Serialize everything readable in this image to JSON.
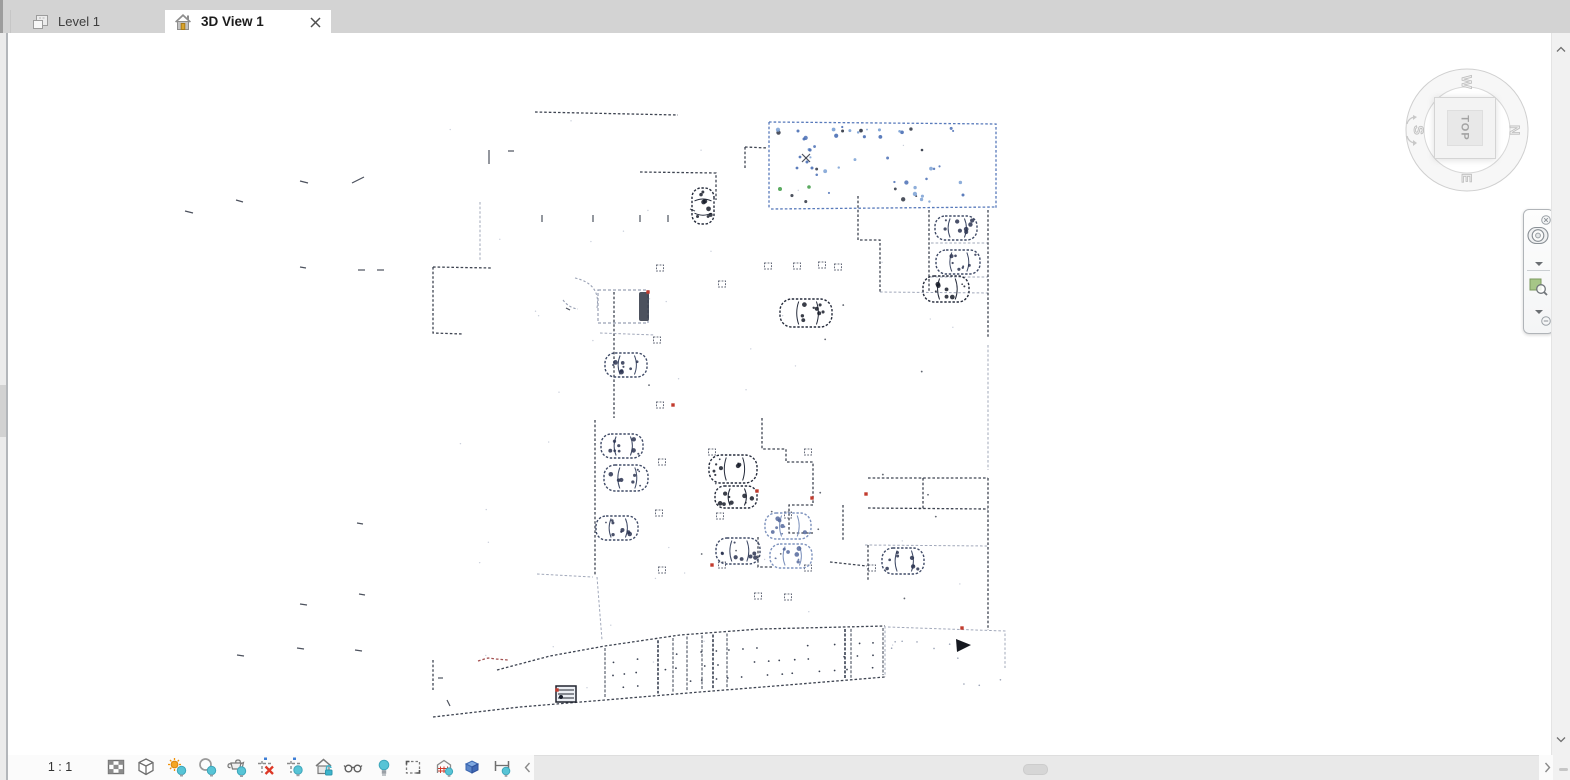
{
  "tabs": [
    {
      "id": "level-1",
      "label": "Level 1",
      "active": false,
      "icon": "floor-plan-icon"
    },
    {
      "id": "3d-view-1",
      "label": "3D View 1",
      "active": true,
      "icon": "home-icon",
      "closable": true
    }
  ],
  "viewcube": {
    "face_label": "TOP",
    "compass": {
      "north": "N",
      "south": "S",
      "east": "E",
      "west": "W"
    },
    "rotation_deg": 90
  },
  "navigation_bar": {
    "close_icon": "close-icon",
    "minimize_icon": "minimize-icon",
    "buttons": [
      {
        "icon": "steering-wheel-icon"
      },
      {
        "icon": "wheel-menu-caret-icon"
      },
      {
        "icon": "zoom-region-icon"
      },
      {
        "icon": "zoom-menu-caret-icon"
      }
    ]
  },
  "view_control_bar": {
    "scale_label": "1 : 1",
    "buttons": [
      {
        "icon": "detail-level-icon"
      },
      {
        "icon": "visual-style-icon"
      },
      {
        "icon": "sun-path-icon"
      },
      {
        "icon": "shadows-icon"
      },
      {
        "icon": "show-rendering-dialog-icon"
      },
      {
        "icon": "crop-view-icon"
      },
      {
        "icon": "show-crop-region-icon"
      },
      {
        "icon": "unlocked-3d-view-icon"
      },
      {
        "icon": "temporary-hide-isolate-icon"
      },
      {
        "icon": "reveal-hidden-elements-icon"
      },
      {
        "icon": "temporary-view-properties-icon"
      },
      {
        "icon": "analytical-model-icon"
      },
      {
        "icon": "displacement-sets-icon"
      },
      {
        "icon": "reveal-constraints-icon"
      }
    ]
  },
  "scrollbars": {
    "horizontal": {
      "thumb_left": 1023,
      "thumb_width": 23
    },
    "left_gutter": {
      "thumb_top": 385,
      "thumb_height": 52
    }
  },
  "point_cloud": {
    "colors": {
      "d": "#2e3442",
      "l": "#99a1b4",
      "b": "#4a6fb5",
      "r": "#9a4040",
      "red": "#c23b2e",
      "green": "#49a14f",
      "dust": "#c3c9d6"
    },
    "walls": [
      {
        "c": "d",
        "p": [
          [
            535,
            112
          ],
          [
            678,
            115
          ]
        ]
      },
      {
        "c": "d",
        "p": [
          [
            640,
            172
          ],
          [
            716,
            173
          ],
          [
            716,
            200
          ]
        ]
      },
      {
        "c": "d",
        "p": [
          [
            745,
            147
          ],
          [
            768,
            148
          ]
        ]
      },
      {
        "c": "d",
        "p": [
          [
            745,
            147
          ],
          [
            745,
            170
          ]
        ]
      },
      {
        "c": "b",
        "p": [
          [
            769,
            122
          ],
          [
            996,
            124
          ],
          [
            996,
            209
          ]
        ]
      },
      {
        "c": "b",
        "p": [
          [
            769,
            122
          ],
          [
            769,
            209
          ]
        ]
      },
      {
        "c": "b",
        "p": [
          [
            771,
            209
          ],
          [
            996,
            207
          ]
        ]
      },
      {
        "c": "d",
        "p": [
          [
            858,
            196
          ],
          [
            858,
            240
          ],
          [
            880,
            240
          ],
          [
            880,
            292
          ]
        ]
      },
      {
        "c": "l",
        "p": [
          [
            880,
            292
          ],
          [
            988,
            293
          ]
        ]
      },
      {
        "c": "d",
        "p": [
          [
            929,
            210
          ],
          [
            929,
            292
          ]
        ]
      },
      {
        "c": "l",
        "p": [
          [
            931,
            243
          ],
          [
            988,
            243
          ]
        ]
      },
      {
        "c": "l",
        "p": [
          [
            931,
            277
          ],
          [
            988,
            277
          ]
        ]
      },
      {
        "c": "d",
        "p": [
          [
            988,
            210
          ],
          [
            988,
            338
          ]
        ]
      },
      {
        "c": "l",
        "p": [
          [
            988,
            345
          ],
          [
            988,
            470
          ]
        ]
      },
      {
        "c": "d",
        "p": [
          [
            988,
            478
          ],
          [
            988,
            630
          ]
        ]
      },
      {
        "c": "d",
        "p": [
          [
            614,
            292
          ],
          [
            614,
            418
          ]
        ]
      },
      {
        "c": "d",
        "p": [
          [
            595,
            420
          ],
          [
            595,
            575
          ]
        ]
      },
      {
        "c": "l",
        "p": [
          [
            597,
            577
          ],
          [
            602,
            640
          ]
        ]
      },
      {
        "c": "d",
        "p": [
          [
            433,
            267
          ],
          [
            492,
            268
          ]
        ]
      },
      {
        "c": "d",
        "p": [
          [
            433,
            267
          ],
          [
            433,
            333
          ],
          [
            463,
            334
          ]
        ]
      },
      {
        "c": "l",
        "p": [
          [
            480,
            202
          ],
          [
            480,
            260
          ]
        ]
      },
      {
        "c": "d",
        "p": [
          [
            762,
            418
          ],
          [
            762,
            449
          ],
          [
            786,
            449
          ],
          [
            786,
            462
          ],
          [
            813,
            462
          ],
          [
            813,
            505
          ],
          [
            789,
            505
          ],
          [
            789,
            533
          ],
          [
            813,
            533
          ]
        ]
      },
      {
        "c": "d",
        "p": [
          [
            843,
            505
          ],
          [
            843,
            540
          ]
        ]
      },
      {
        "c": "d",
        "p": [
          [
            758,
            537
          ],
          [
            758,
            567
          ],
          [
            774,
            567
          ]
        ]
      },
      {
        "c": "d",
        "p": [
          [
            868,
            478
          ],
          [
            988,
            478
          ]
        ]
      },
      {
        "c": "d",
        "p": [
          [
            868,
            508
          ],
          [
            988,
            509
          ]
        ]
      },
      {
        "c": "d",
        "p": [
          [
            923,
            478
          ],
          [
            923,
            510
          ]
        ]
      },
      {
        "c": "d",
        "p": [
          [
            868,
            545
          ],
          [
            868,
            580
          ]
        ]
      },
      {
        "c": "l",
        "p": [
          [
            865,
            545
          ],
          [
            988,
            546
          ]
        ]
      },
      {
        "c": "d",
        "p": [
          [
            830,
            562
          ],
          [
            867,
            566
          ]
        ]
      },
      {
        "c": "l",
        "p": [
          [
            888,
            627
          ],
          [
            1005,
            631
          ],
          [
            1005,
            668
          ]
        ]
      },
      {
        "c": "d",
        "p": [
          [
            433,
            660
          ],
          [
            433,
            690
          ]
        ]
      },
      {
        "c": "l",
        "p": [
          [
            600,
            333
          ],
          [
            655,
            335
          ]
        ]
      },
      {
        "c": "l",
        "p": [
          [
            537,
            574
          ],
          [
            593,
            577
          ]
        ]
      },
      {
        "c": "d",
        "p": [
          [
            497,
            670
          ],
          [
            550,
            656
          ],
          [
            605,
            646
          ],
          [
            680,
            635
          ],
          [
            760,
            629
          ],
          [
            885,
            626
          ]
        ]
      },
      {
        "c": "d",
        "p": [
          [
            433,
            717
          ],
          [
            520,
            707
          ],
          [
            605,
            700
          ],
          [
            700,
            692
          ],
          [
            800,
            684
          ],
          [
            885,
            677
          ]
        ]
      },
      {
        "c": "l",
        "p": [
          [
            885,
            626
          ],
          [
            885,
            677
          ]
        ]
      },
      {
        "c": "r",
        "p": [
          [
            478,
            661
          ],
          [
            488,
            658
          ],
          [
            496,
            659
          ],
          [
            508,
            660
          ]
        ]
      }
    ],
    "curves": [
      {
        "c": "l",
        "d": "M575,278 Q601,284 597,308"
      },
      {
        "c": "l",
        "d": "M563,300 q6,8 15,9"
      }
    ],
    "cars": [
      [
        703,
        206,
        90,
        36,
        22,
        0
      ],
      [
        956,
        228,
        0,
        42,
        24,
        1
      ],
      [
        958,
        262,
        0,
        44,
        24,
        1
      ],
      [
        946,
        289,
        0,
        46,
        26,
        0
      ],
      [
        806,
        313,
        0,
        52,
        28,
        0
      ],
      [
        626,
        365,
        0,
        42,
        24,
        1
      ],
      [
        622,
        446,
        0,
        42,
        24,
        1
      ],
      [
        626,
        478,
        0,
        44,
        26,
        1
      ],
      [
        617,
        528,
        0,
        42,
        24,
        1
      ],
      [
        733,
        469,
        0,
        48,
        28,
        0
      ],
      [
        736,
        497,
        0,
        42,
        22,
        0
      ],
      [
        738,
        551,
        0,
        44,
        26,
        1
      ],
      [
        788,
        526,
        0,
        46,
        26,
        2
      ],
      [
        791,
        556,
        0,
        42,
        24,
        2
      ],
      [
        903,
        561,
        0,
        42,
        26,
        1
      ]
    ],
    "dashed_rect": {
      "x": 598,
      "y": 290,
      "w": 50,
      "h": 33
    },
    "columns": [
      [
        768,
        266
      ],
      [
        797,
        266
      ],
      [
        822,
        265
      ],
      [
        838,
        267
      ],
      [
        722,
        284
      ],
      [
        660,
        268
      ],
      [
        657,
        340
      ],
      [
        660,
        405
      ],
      [
        662,
        462
      ],
      [
        659,
        513
      ],
      [
        662,
        570
      ],
      [
        712,
        452
      ],
      [
        808,
        452
      ],
      [
        720,
        516
      ],
      [
        788,
        515
      ],
      [
        722,
        565
      ],
      [
        808,
        568
      ],
      [
        872,
        568
      ],
      [
        758,
        596
      ],
      [
        788,
        597
      ]
    ],
    "red_marks": [
      [
        648,
        292
      ],
      [
        673,
        405
      ],
      [
        812,
        498
      ],
      [
        866,
        494
      ],
      [
        712,
        565
      ],
      [
        557,
        690
      ],
      [
        757,
        491
      ],
      [
        962,
        628
      ]
    ],
    "scatter": [
      [
        185,
        211,
        8,
        2
      ],
      [
        236,
        200,
        7,
        2
      ],
      [
        300,
        181,
        8,
        2
      ],
      [
        352,
        183,
        12,
        -6
      ],
      [
        508,
        151,
        6,
        0
      ],
      [
        489,
        150,
        0,
        14
      ],
      [
        358,
        270,
        7,
        0
      ],
      [
        377,
        270,
        7,
        0
      ],
      [
        300,
        267,
        6,
        1
      ],
      [
        542,
        215,
        0,
        7
      ],
      [
        593,
        215,
        0,
        7
      ],
      [
        640,
        215,
        0,
        7
      ],
      [
        668,
        215,
        0,
        7
      ],
      [
        357,
        523,
        6,
        1
      ],
      [
        359,
        594,
        6,
        1
      ],
      [
        300,
        604,
        7,
        1
      ],
      [
        237,
        655,
        7,
        1
      ],
      [
        297,
        648,
        7,
        1
      ],
      [
        355,
        650,
        7,
        1
      ],
      [
        438,
        678,
        5,
        0
      ],
      [
        447,
        700,
        3,
        6
      ],
      [
        802,
        154,
        8,
        8
      ],
      [
        802,
        162,
        8,
        -8
      ],
      [
        566,
        308,
        4,
        2
      ],
      [
        690,
        209,
        5,
        2
      ]
    ],
    "dots": [
      [
        798,
        131,
        1.5,
        "b"
      ],
      [
        804,
        139,
        1.5,
        "b"
      ],
      [
        810,
        150,
        1.6,
        "b"
      ],
      [
        800,
        157,
        1.4,
        "b"
      ],
      [
        807,
        162,
        1.5,
        "b"
      ],
      [
        797,
        168,
        1.4,
        "b"
      ],
      [
        812,
        168,
        1.5,
        "b"
      ],
      [
        780,
        189,
        2,
        "green"
      ],
      [
        809,
        187,
        1.8,
        "green"
      ],
      [
        963,
        195,
        1.5,
        "b"
      ],
      [
        922,
        150,
        1.3,
        "d"
      ]
    ],
    "blue_room": {
      "x": 776,
      "y": 128,
      "w": 214,
      "h": 74,
      "n": 34,
      "band_n": 12
    },
    "dust": {
      "n": 46,
      "x": 430,
      "y": 115,
      "w": 575,
      "h": 590
    },
    "sparse": {
      "n": 16,
      "x": 620,
      "y": 300,
      "w": 360,
      "h": 310
    },
    "ramp": {
      "stripes": [
        605,
        658,
        673,
        687,
        702,
        713,
        727,
        845,
        851,
        883
      ],
      "dark_stripes": [
        658,
        713,
        845
      ],
      "top": [
        [
          497,
          670
        ],
        [
          550,
          656
        ],
        [
          605,
          646
        ],
        [
          680,
          635
        ],
        [
          760,
          629
        ],
        [
          885,
          626
        ]
      ],
      "bottom": [
        [
          433,
          717
        ],
        [
          520,
          707
        ],
        [
          605,
          700
        ],
        [
          700,
          692
        ],
        [
          800,
          684
        ],
        [
          885,
          677
        ]
      ],
      "dot_x0": 612,
      "dot_x1": 878,
      "dot_step": 13,
      "rows": [
        0.32,
        0.56,
        0.8
      ],
      "right_n": 10
    },
    "stairs": {
      "x": 556,
      "y": 686,
      "w": 20,
      "h": 16
    },
    "arrow": [
      [
        956,
        639
      ],
      [
        971,
        645
      ],
      [
        957,
        652
      ]
    ]
  }
}
